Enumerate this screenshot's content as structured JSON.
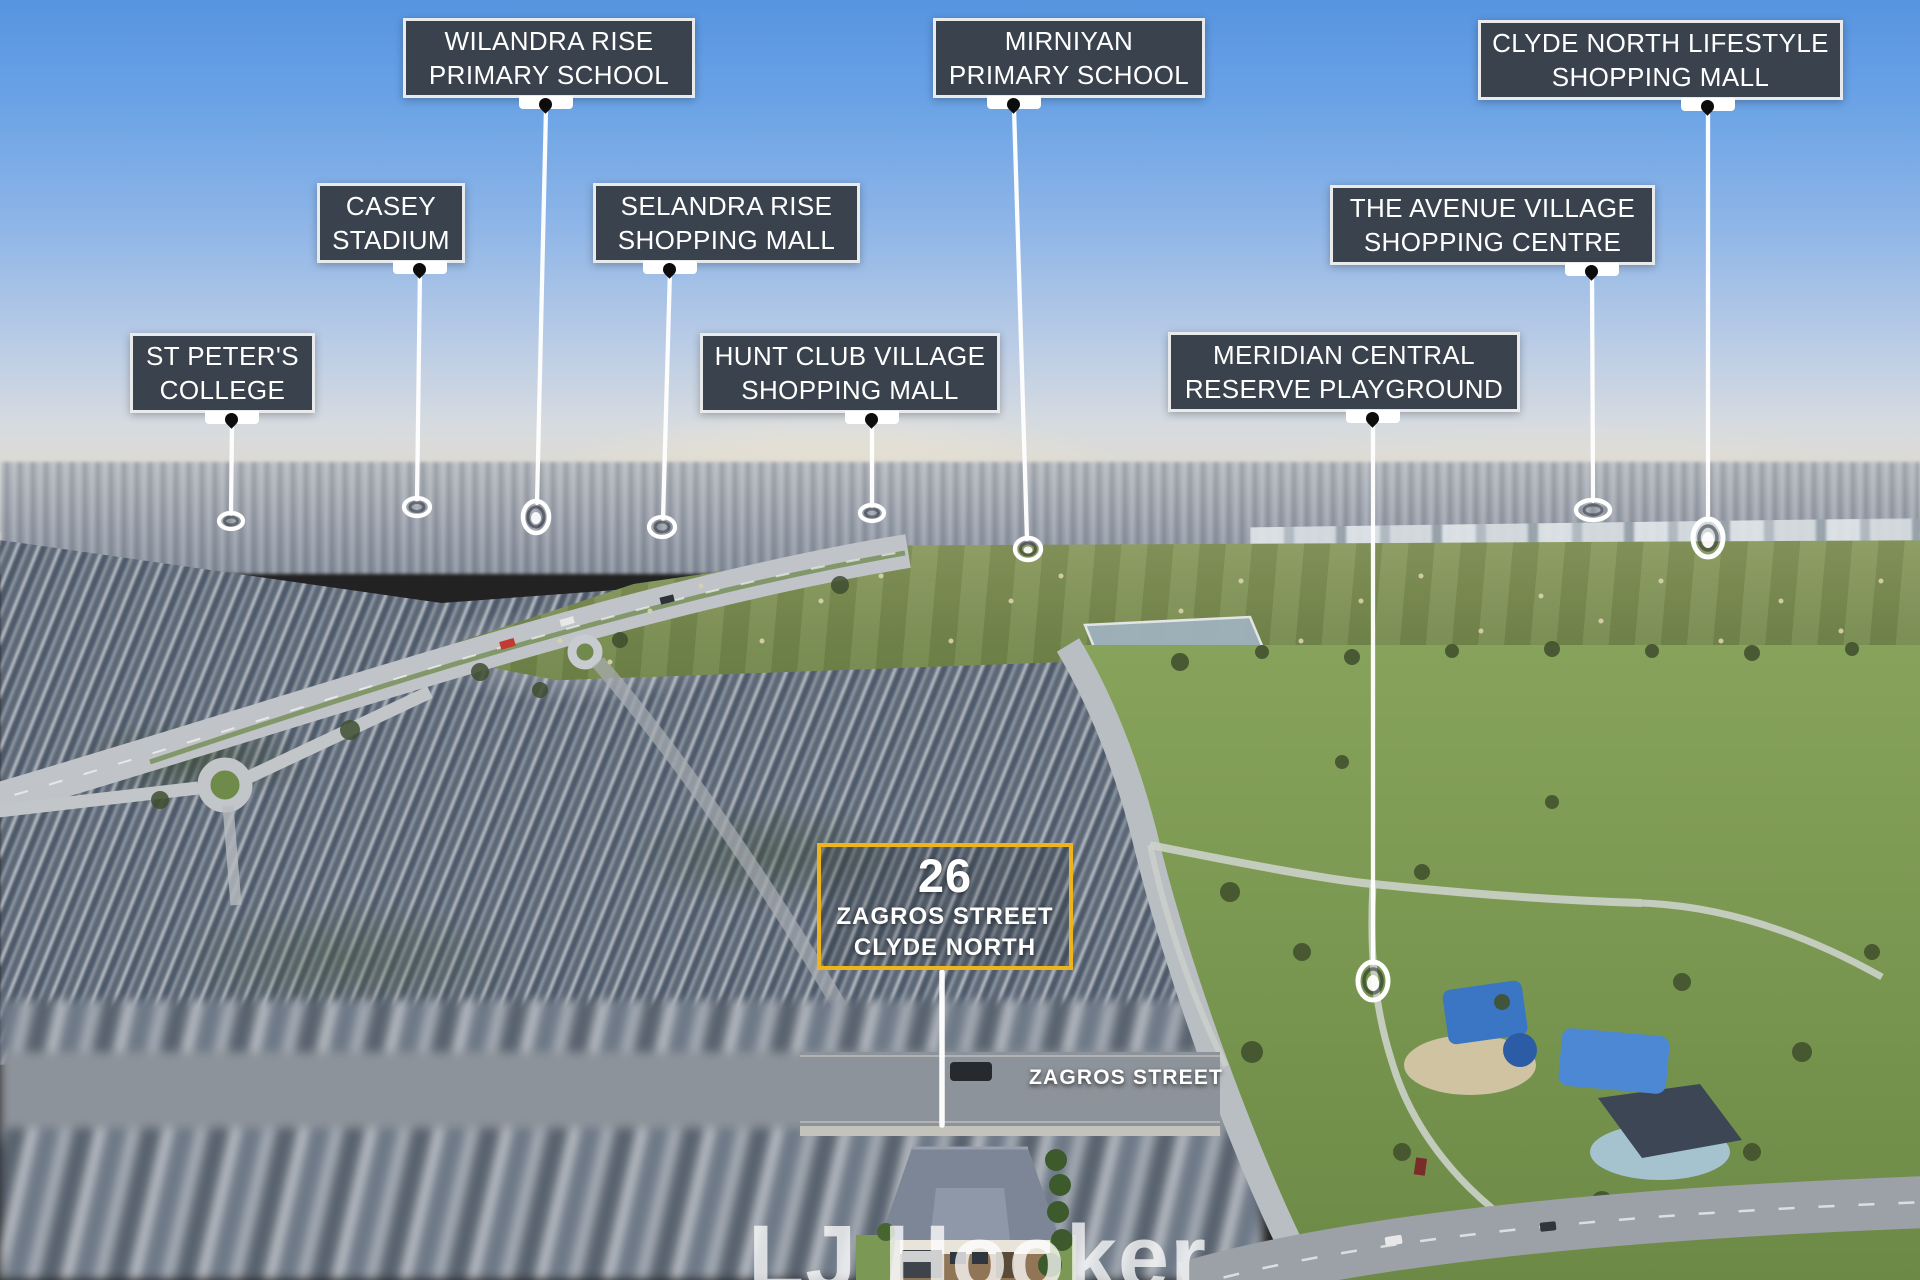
{
  "scene": {
    "description": "Aerial drone photograph of a residential suburb (Clyde North) with landmark location callouts",
    "width_px": 1920,
    "height_px": 1280
  },
  "colors": {
    "label_background": "#3a434d",
    "label_border": "#f8f8f8",
    "label_text": "#ffffff",
    "pointer_line": "#ffffff",
    "pin_glyph": "#0c0c0c",
    "property_border_gold": "#eeb41c",
    "watermark_text": "#ffffff"
  },
  "landmarks": [
    {
      "name": "Wilandra Rise Primary School",
      "line1": "WILANDRA RISE",
      "line2": "PRIMARY SCHOOL"
    },
    {
      "name": "Casey Stadium",
      "line1": "CASEY",
      "line2": "STADIUM"
    },
    {
      "name": "St Peter's College",
      "line1": "ST PETER'S",
      "line2": "COLLEGE"
    },
    {
      "name": "Selandra Rise Shopping Mall",
      "line1": "SELANDRA RISE",
      "line2": "SHOPPING MALL"
    },
    {
      "name": "Hunt Club Village Shopping Mall",
      "line1": "HUNT CLUB VILLAGE",
      "line2": "SHOPPING MALL"
    },
    {
      "name": "Mirniyan Primary School",
      "line1": "MIRNIYAN",
      "line2": "PRIMARY SCHOOL"
    },
    {
      "name": "Meridian Central Reserve Playground",
      "line1": "MERIDIAN CENTRAL",
      "line2": "RESERVE PLAYGROUND"
    },
    {
      "name": "The Avenue Village Shopping Centre",
      "line1": "THE AVENUE VILLAGE",
      "line2": "SHOPPING CENTRE"
    },
    {
      "name": "Clyde North Lifestyle Shopping Mall",
      "line1": "CLYDE NORTH LIFESTYLE",
      "line2": "SHOPPING MALL"
    }
  ],
  "property_callout": {
    "street_number": "26",
    "street_name": "ZAGROS STREET",
    "suburb": "CLYDE NORTH"
  },
  "street_label": {
    "text": "ZAGROS STREET"
  },
  "watermark": {
    "brand": "LJ Hooker"
  }
}
